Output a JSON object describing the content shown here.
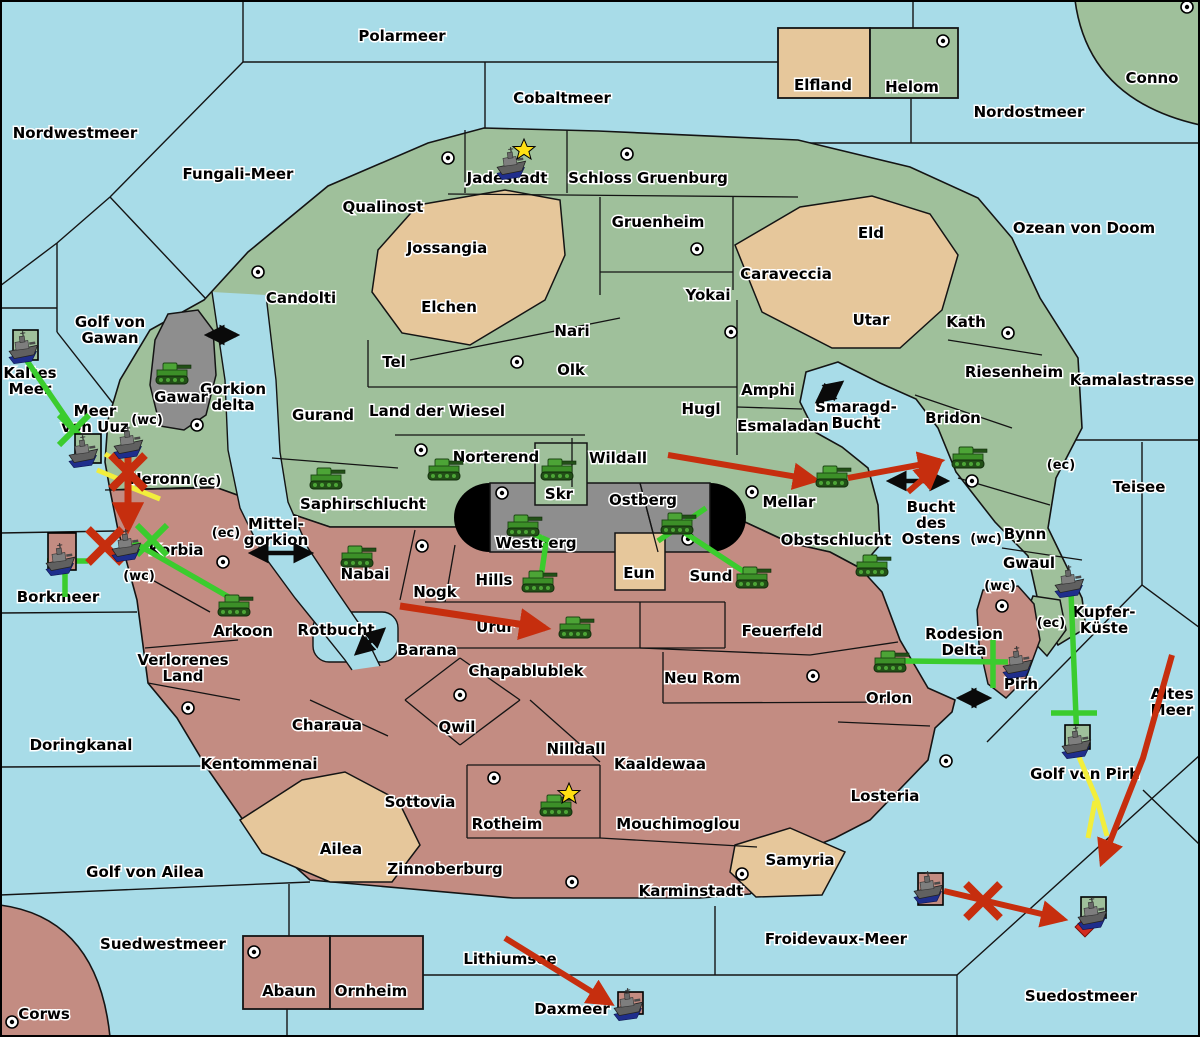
{
  "palette": {
    "sea": "#A8DCE8",
    "land_green": "#9FC09B",
    "land_tan": "#E6C79B",
    "land_rose": "#C38C82",
    "land_gray": "#8E8E8E",
    "cap_black": "#000000",
    "border": "#141414",
    "arrow_red": "#C62E0E",
    "line_green": "#3BCC2E",
    "line_yellow": "#F2EE3C",
    "double_arrow_black": "#0A0A0A",
    "star_yellow": "#FFE013",
    "diamond_red": "#D42B20",
    "label_text": "#000000",
    "label_halo": "#FFFFFF"
  },
  "sea_labels": [
    {
      "t": "Polarmeer",
      "x": 402,
      "y": 36
    },
    {
      "t": "Cobaltmeer",
      "x": 562,
      "y": 98
    },
    {
      "t": "Nordwestmeer",
      "x": 75,
      "y": 133
    },
    {
      "t": "Nordostmeer",
      "x": 1029,
      "y": 112
    },
    {
      "t": "Fungali-Meer",
      "x": 238,
      "y": 174
    },
    {
      "t": "Ozean von Doom",
      "x": 1084,
      "y": 228
    },
    {
      "t": "Golf von\nGawan",
      "x": 110,
      "y": 330
    },
    {
      "t": "Kaltes\nMeer",
      "x": 30,
      "y": 381
    },
    {
      "t": "Meer\nvon Uuz",
      "x": 95,
      "y": 419
    },
    {
      "t": "Gorkion\ndelta",
      "x": 233,
      "y": 397
    },
    {
      "t": "Kamalastrasse",
      "x": 1132,
      "y": 380
    },
    {
      "t": "Smaragd-\nBucht",
      "x": 856,
      "y": 415
    },
    {
      "t": "Teisee",
      "x": 1139,
      "y": 487
    },
    {
      "t": "Bucht\ndes\nOstens",
      "x": 931,
      "y": 523
    },
    {
      "t": "Mittel-\ngorkion",
      "x": 276,
      "y": 532
    },
    {
      "t": "Borkmeer",
      "x": 58,
      "y": 597
    },
    {
      "t": "Rotbucht",
      "x": 336,
      "y": 630
    },
    {
      "t": "Doringkanal",
      "x": 81,
      "y": 745
    },
    {
      "t": "Golf von Ailea",
      "x": 145,
      "y": 872
    },
    {
      "t": "Altes\nMeer",
      "x": 1172,
      "y": 702
    },
    {
      "t": "Rodesion\nDelta",
      "x": 964,
      "y": 642
    },
    {
      "t": "Golf von Pirh",
      "x": 1085,
      "y": 774
    },
    {
      "t": "Suedwestmeer",
      "x": 163,
      "y": 944
    },
    {
      "t": "Lithiumsee",
      "x": 510,
      "y": 959
    },
    {
      "t": "Daxmeer",
      "x": 572,
      "y": 1009
    },
    {
      "t": "Froidevaux-Meer",
      "x": 836,
      "y": 939
    },
    {
      "t": "Suedostmeer",
      "x": 1081,
      "y": 996
    }
  ],
  "territory_labels": [
    {
      "t": "Qualinost",
      "x": 383,
      "y": 207
    },
    {
      "t": "Jadestadt",
      "x": 507,
      "y": 178
    },
    {
      "t": "Schloss Gruenburg",
      "x": 648,
      "y": 178
    },
    {
      "t": "Gruenheim",
      "x": 658,
      "y": 222
    },
    {
      "t": "Jossangia",
      "x": 447,
      "y": 248
    },
    {
      "t": "Candolti",
      "x": 301,
      "y": 298
    },
    {
      "t": "Elchen",
      "x": 449,
      "y": 307
    },
    {
      "t": "Yokai",
      "x": 708,
      "y": 295
    },
    {
      "t": "Caraveccia",
      "x": 786,
      "y": 274
    },
    {
      "t": "Eld",
      "x": 871,
      "y": 233
    },
    {
      "t": "Utar",
      "x": 871,
      "y": 320
    },
    {
      "t": "Kath",
      "x": 966,
      "y": 322
    },
    {
      "t": "Riesenheim",
      "x": 1014,
      "y": 372
    },
    {
      "t": "Nari",
      "x": 572,
      "y": 331
    },
    {
      "t": "Tel",
      "x": 394,
      "y": 362
    },
    {
      "t": "Olk",
      "x": 571,
      "y": 370
    },
    {
      "t": "Gurand",
      "x": 323,
      "y": 415
    },
    {
      "t": "Land der Wiesel",
      "x": 437,
      "y": 411
    },
    {
      "t": "Hugl",
      "x": 701,
      "y": 409
    },
    {
      "t": "Amphi",
      "x": 768,
      "y": 390
    },
    {
      "t": "Esmaladan",
      "x": 783,
      "y": 426
    },
    {
      "t": "Bridon",
      "x": 953,
      "y": 418
    },
    {
      "t": "Gawar",
      "x": 181,
      "y": 397
    },
    {
      "t": "Norterend",
      "x": 496,
      "y": 457
    },
    {
      "t": "Wildall",
      "x": 618,
      "y": 458
    },
    {
      "t": "Mellar",
      "x": 789,
      "y": 502
    },
    {
      "t": "Skr",
      "x": 559,
      "y": 494
    },
    {
      "t": "Ostberg",
      "x": 643,
      "y": 500
    },
    {
      "t": "Westberg",
      "x": 536,
      "y": 543
    },
    {
      "t": "Heronn",
      "x": 160,
      "y": 479
    },
    {
      "t": "Korbia",
      "x": 176,
      "y": 550
    },
    {
      "t": "Saphirschlucht",
      "x": 363,
      "y": 504
    },
    {
      "t": "Obstschlucht",
      "x": 836,
      "y": 540
    },
    {
      "t": "Sund",
      "x": 711,
      "y": 576
    },
    {
      "t": "Eun",
      "x": 639,
      "y": 573
    },
    {
      "t": "Hills",
      "x": 494,
      "y": 580
    },
    {
      "t": "Nabai",
      "x": 365,
      "y": 574
    },
    {
      "t": "Nogk",
      "x": 435,
      "y": 592
    },
    {
      "t": "Urur",
      "x": 495,
      "y": 627
    },
    {
      "t": "Feuerfeld",
      "x": 782,
      "y": 631
    },
    {
      "t": "Arkoon",
      "x": 243,
      "y": 631
    },
    {
      "t": "Barana",
      "x": 427,
      "y": 650
    },
    {
      "t": "Verlorenes\nLand",
      "x": 183,
      "y": 668
    },
    {
      "t": "Chapablublek",
      "x": 526,
      "y": 671
    },
    {
      "t": "Neu Rom",
      "x": 702,
      "y": 678
    },
    {
      "t": "Orlon",
      "x": 889,
      "y": 698
    },
    {
      "t": "Pirh",
      "x": 1021,
      "y": 684
    },
    {
      "t": "Kupfer-\nKüste",
      "x": 1104,
      "y": 620
    },
    {
      "t": "Bynn",
      "x": 1025,
      "y": 534
    },
    {
      "t": "Gwaul",
      "x": 1029,
      "y": 563
    },
    {
      "t": "Charaua",
      "x": 327,
      "y": 725
    },
    {
      "t": "Kentommenai",
      "x": 259,
      "y": 764
    },
    {
      "t": "Qwil",
      "x": 457,
      "y": 727
    },
    {
      "t": "Nilldall",
      "x": 576,
      "y": 749
    },
    {
      "t": "Kaaldewaa",
      "x": 660,
      "y": 764
    },
    {
      "t": "Sottovia",
      "x": 420,
      "y": 802
    },
    {
      "t": "Rotheim",
      "x": 507,
      "y": 824
    },
    {
      "t": "Mouchimoglou",
      "x": 678,
      "y": 824
    },
    {
      "t": "Losteria",
      "x": 885,
      "y": 796
    },
    {
      "t": "Zinnoberburg",
      "x": 445,
      "y": 869
    },
    {
      "t": "Karminstadt",
      "x": 691,
      "y": 891
    },
    {
      "t": "Samyria",
      "x": 800,
      "y": 860
    },
    {
      "t": "Ailea",
      "x": 341,
      "y": 849
    },
    {
      "t": "Abaun",
      "x": 289,
      "y": 991
    },
    {
      "t": "Ornheim",
      "x": 371,
      "y": 991
    },
    {
      "t": "Corws",
      "x": 44,
      "y": 1014
    },
    {
      "t": "Elfland",
      "x": 823,
      "y": 85
    },
    {
      "t": "Helom",
      "x": 912,
      "y": 87
    },
    {
      "t": "Conno",
      "x": 1152,
      "y": 78
    }
  ],
  "coast_markers": [
    {
      "t": "(wc)",
      "x": 147,
      "y": 419
    },
    {
      "t": "(ec)",
      "x": 207,
      "y": 480
    },
    {
      "t": "(ec)",
      "x": 226,
      "y": 532
    },
    {
      "t": "(wc)",
      "x": 139,
      "y": 575
    },
    {
      "t": "(ec)",
      "x": 1061,
      "y": 464
    },
    {
      "t": "(wc)",
      "x": 986,
      "y": 538
    },
    {
      "t": "(wc)",
      "x": 1000,
      "y": 585
    },
    {
      "t": "(ec)",
      "x": 1051,
      "y": 622
    }
  ],
  "city_markers": [
    [
      258,
      272
    ],
    [
      448,
      158
    ],
    [
      627,
      154
    ],
    [
      697,
      249
    ],
    [
      943,
      41
    ],
    [
      1187,
      7
    ],
    [
      197,
      425
    ],
    [
      421,
      450
    ],
    [
      517,
      362
    ],
    [
      731,
      332
    ],
    [
      1008,
      333
    ],
    [
      502,
      493
    ],
    [
      688,
      539
    ],
    [
      752,
      492
    ],
    [
      972,
      481
    ],
    [
      1002,
      606
    ],
    [
      813,
      676
    ],
    [
      946,
      761
    ],
    [
      460,
      695
    ],
    [
      494,
      778
    ],
    [
      422,
      546
    ],
    [
      572,
      882
    ],
    [
      742,
      874
    ],
    [
      254,
      952
    ],
    [
      12,
      1022
    ],
    [
      188,
      708
    ],
    [
      223,
      562
    ]
  ],
  "units": {
    "tanks": [
      {
        "x": 172,
        "y": 374,
        "at": "Gawar"
      },
      {
        "x": 326,
        "y": 479,
        "at": "Saphirschlucht"
      },
      {
        "x": 357,
        "y": 557,
        "at": "Nabai"
      },
      {
        "x": 444,
        "y": 470,
        "at": "Norterend"
      },
      {
        "x": 557,
        "y": 470,
        "at": "Skr"
      },
      {
        "x": 523,
        "y": 526,
        "at": "Westberg"
      },
      {
        "x": 677,
        "y": 524,
        "at": "Ostberg"
      },
      {
        "x": 538,
        "y": 582,
        "at": "Hills"
      },
      {
        "x": 752,
        "y": 578,
        "at": "Sund"
      },
      {
        "x": 832,
        "y": 477,
        "at": "Mellar"
      },
      {
        "x": 968,
        "y": 458,
        "at": "Bridon"
      },
      {
        "x": 872,
        "y": 566,
        "at": "Obstschlucht"
      },
      {
        "x": 575,
        "y": 628,
        "at": "Urur"
      },
      {
        "x": 556,
        "y": 806,
        "at": "Rotheim"
      },
      {
        "x": 234,
        "y": 606,
        "at": "Arkoon"
      },
      {
        "x": 890,
        "y": 662,
        "at": "Orlon"
      }
    ],
    "ships": [
      {
        "x": 513,
        "y": 165,
        "at": "Jadestadt",
        "box": null
      },
      {
        "x": 25,
        "y": 349,
        "at": "Kaltes Meer",
        "box": {
          "x": 13,
          "y": 330,
          "w": 25,
          "h": 30,
          "c": "green"
        }
      },
      {
        "x": 85,
        "y": 453,
        "at": "Meer von Uuz",
        "box": {
          "x": 75,
          "y": 434,
          "w": 26,
          "h": 29,
          "c": "green"
        }
      },
      {
        "x": 130,
        "y": 444,
        "at": "Heronn",
        "box": null
      },
      {
        "x": 128,
        "y": 547,
        "at": "Korbia",
        "box": null
      },
      {
        "x": 62,
        "y": 561,
        "at": "Borkmeer",
        "box": {
          "x": 48,
          "y": 533,
          "w": 28,
          "h": 37,
          "c": "rose"
        }
      },
      {
        "x": 1071,
        "y": 583,
        "at": "Gwaul",
        "box": null
      },
      {
        "x": 1019,
        "y": 664,
        "at": "Pirh",
        "box": null
      },
      {
        "x": 1078,
        "y": 744,
        "at": "Golf von Pirh",
        "box": {
          "x": 1065,
          "y": 725,
          "w": 25,
          "h": 24,
          "c": "green"
        }
      },
      {
        "x": 930,
        "y": 889,
        "at": "Froidevaux-Meer",
        "box": {
          "x": 918,
          "y": 873,
          "w": 25,
          "h": 32,
          "c": "rose"
        }
      },
      {
        "x": 1094,
        "y": 915,
        "at": "Suedostmeer",
        "box": {
          "x": 1081,
          "y": 897,
          "w": 25,
          "h": 21,
          "c": "green"
        }
      },
      {
        "x": 630,
        "y": 1006,
        "at": "Daxmeer",
        "box": {
          "x": 618,
          "y": 992,
          "w": 25,
          "h": 22,
          "c": "rose"
        }
      }
    ]
  },
  "stars": [
    {
      "x": 524,
      "y": 150,
      "at": "Jadestadt"
    },
    {
      "x": 569,
      "y": 794,
      "at": "Rotheim"
    }
  ],
  "movement_arrows": {
    "red": [
      {
        "points": [
          [
            668,
            455
          ],
          [
            815,
            480
          ]
        ],
        "w": 6
      },
      {
        "points": [
          [
            848,
            478
          ],
          [
            940,
            461
          ]
        ],
        "w": 6
      },
      {
        "points": [
          [
            908,
            492
          ],
          [
            938,
            466
          ]
        ],
        "w": 6
      },
      {
        "points": [
          [
            128,
            452
          ],
          [
            128,
            528
          ]
        ],
        "w": 7
      },
      {
        "points": [
          [
            400,
            606
          ],
          [
            545,
            628
          ]
        ],
        "w": 7
      },
      {
        "points": [
          [
            1172,
            655
          ],
          [
            1143,
            758
          ],
          [
            1102,
            862
          ]
        ],
        "w": 6
      },
      {
        "points": [
          [
            944,
            891
          ],
          [
            1063,
            919
          ]
        ],
        "w": 6
      },
      {
        "points": [
          [
            505,
            938
          ],
          [
            610,
            1003
          ]
        ],
        "w": 6
      }
    ],
    "green": [
      {
        "points": [
          [
            25,
            358
          ],
          [
            80,
            438
          ]
        ]
      },
      {
        "points": [
          [
            65,
            537
          ],
          [
            65,
            597
          ]
        ]
      },
      {
        "points": [
          [
            47,
            561
          ],
          [
            88,
            561
          ]
        ]
      },
      {
        "points": [
          [
            133,
            542
          ],
          [
            234,
            600
          ]
        ]
      },
      {
        "points": [
          [
            520,
            528
          ],
          [
            549,
            541
          ]
        ]
      },
      {
        "points": [
          [
            546,
            543
          ],
          [
            540,
            584
          ]
        ]
      },
      {
        "points": [
          [
            658,
            541
          ],
          [
            706,
            508
          ]
        ]
      },
      {
        "points": [
          [
            679,
            529
          ],
          [
            749,
            575
          ]
        ]
      },
      {
        "points": [
          [
            903,
            661
          ],
          [
            1008,
            662
          ]
        ]
      },
      {
        "points": [
          [
            993,
            640
          ],
          [
            993,
            688
          ]
        ]
      },
      {
        "points": [
          [
            1071,
            592
          ],
          [
            1077,
            742
          ]
        ]
      },
      {
        "points": [
          [
            1051,
            713
          ],
          [
            1097,
            713
          ]
        ]
      }
    ],
    "yellow": [
      {
        "points": [
          [
            105,
            454
          ],
          [
            128,
            467
          ]
        ]
      },
      {
        "points": [
          [
            97,
            470
          ],
          [
            121,
            480
          ]
        ]
      },
      {
        "points": [
          [
            130,
            487
          ],
          [
            160,
            499
          ]
        ]
      },
      {
        "points": [
          [
            1079,
            757
          ],
          [
            1097,
            800
          ],
          [
            1107,
            836
          ]
        ]
      },
      {
        "points": [
          [
            1095,
            801
          ],
          [
            1088,
            838
          ]
        ]
      }
    ],
    "black_double": [
      {
        "points": [
          [
            208,
            335
          ],
          [
            236,
            335
          ]
        ]
      },
      {
        "points": [
          [
            252,
            553
          ],
          [
            310,
            553
          ]
        ]
      },
      {
        "points": [
          [
            818,
            401
          ],
          [
            841,
            383
          ]
        ]
      },
      {
        "points": [
          [
            890,
            481
          ],
          [
            946,
            481
          ]
        ]
      },
      {
        "points": [
          [
            357,
            653
          ],
          [
            383,
            630
          ]
        ]
      },
      {
        "points": [
          [
            960,
            698
          ],
          [
            988,
            698
          ]
        ]
      }
    ]
  },
  "battle_marks": {
    "red_x": [
      [
        128,
        472
      ],
      [
        105,
        546
      ],
      [
        983,
        901
      ]
    ],
    "green_x": [
      [
        74,
        430
      ],
      [
        152,
        540
      ]
    ],
    "red_diamond": [
      [
        1085,
        927
      ]
    ]
  }
}
